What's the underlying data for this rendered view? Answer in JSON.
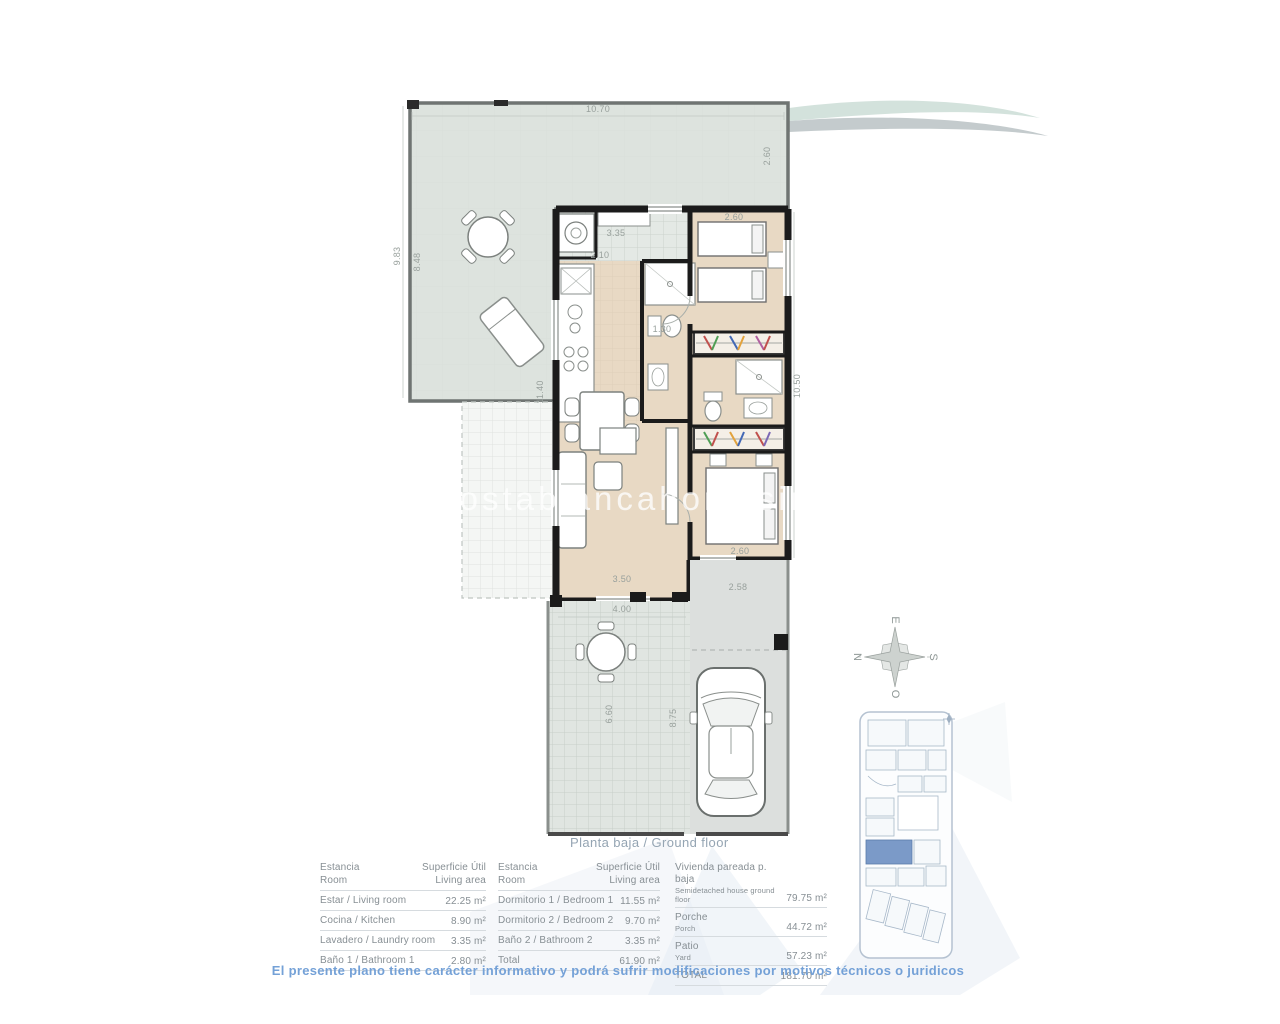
{
  "plan": {
    "caption": "Planta baja / Ground floor",
    "watermark": "costablancahomesinspain",
    "disclaimer": "El presente plano tiene carácter informativo y podrá sufrir modificaciones por motivos técnicos o juridicos",
    "dimensions": {
      "top_width": "10.70",
      "terrace_right_height": "2.60",
      "terrace_left_outer": "9.83",
      "terrace_left_inner": "8.48",
      "house_left_height": "11.40",
      "corridor_width": "3.35",
      "kitchen_width": "2.10",
      "bath1_width": "1.30",
      "bedroom1_width": "2.60",
      "right_side_height": "10.50",
      "bedroom2_width": "2.60",
      "living_width": "3.50",
      "rear_porch_width": "2.58",
      "patio_width": "4.00",
      "patio_height": "6.60",
      "driveway_height": "8.75"
    },
    "compass": {
      "top": "E",
      "left": "N",
      "right": "S",
      "bottom": "O"
    }
  },
  "colors": {
    "disclaimer_blue": "#74a1d7",
    "caption_gray": "#95a5b3",
    "table_text_gray": "#878f94",
    "terrace_fill": "#dde3de",
    "floor_tan": "#e8d9c4",
    "tile_gray": "#e4e9e5",
    "wall_black": "#1b1b1b",
    "highlight_unit_blue": "#7b9ac8",
    "swoosh_teal": "#d3e2dc",
    "swoosh_gray": "#c4cbcd"
  },
  "tables": {
    "rooms_left": {
      "header": {
        "col1_es": "Estancia",
        "col1_en": "Room",
        "col2_es": "Superficie Útil",
        "col2_en": "Living area"
      },
      "rows": [
        {
          "label": "Estar / Living room",
          "value": "22.25 m²"
        },
        {
          "label": "Cocina / Kitchen",
          "value": "8.90 m²"
        },
        {
          "label": "Lavadero / Laundry room",
          "value": "3.35 m²"
        },
        {
          "label": "Baño 1 / Bathroom 1",
          "value": "2.80 m²"
        }
      ]
    },
    "rooms_right": {
      "header": {
        "col1_es": "Estancia",
        "col1_en": "Room",
        "col2_es": "Superficie Útil",
        "col2_en": "Living area"
      },
      "rows": [
        {
          "label": "Dormitorio 1 / Bedroom 1",
          "value": "11.55 m²"
        },
        {
          "label": "Dormitorio 2 / Bedroom 2",
          "value": "9.70 m²"
        },
        {
          "label": "Baño 2 / Bathroom 2",
          "value": "3.35 m²"
        },
        {
          "label": "Total",
          "value": "61.90 m²"
        }
      ]
    },
    "totals": {
      "rows": [
        {
          "label_es": "Vivienda pareada p. baja",
          "label_en": "Semidetached house ground floor",
          "value": "79.75 m²"
        },
        {
          "label_es": "Porche",
          "label_en": "Porch",
          "value": "44.72 m²"
        },
        {
          "label_es": "Patio",
          "label_en": "Yard",
          "value": "57.23 m²"
        },
        {
          "label_es": "TOTAL",
          "label_en": "",
          "value": "181.70 m²"
        }
      ]
    }
  }
}
